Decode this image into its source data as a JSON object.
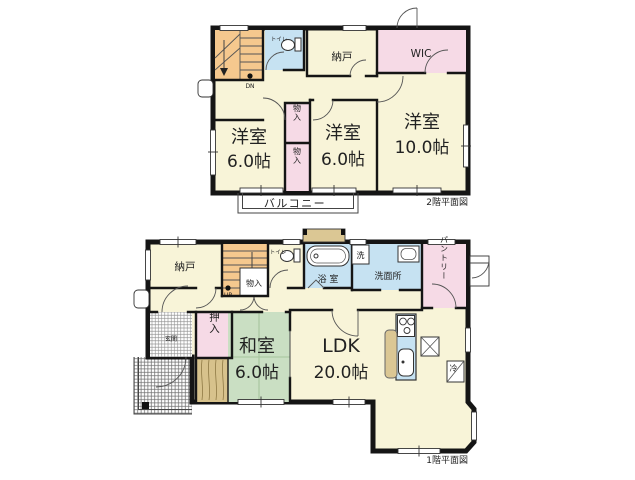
{
  "document": {
    "type": "floor-plan",
    "background": "#ffffff"
  },
  "colors": {
    "wall": "#151515",
    "cream": "#F8F4D8",
    "orange": "#F5C88E",
    "pink": "#F6DAE6",
    "blue": "#C6E2F2",
    "green": "#CADFC3",
    "wood": "#D7C28C",
    "tan": "#DBC794",
    "white": "#FFFFFF"
  },
  "floor2": {
    "title": "2階平面図",
    "stairs": {
      "label": "DN"
    },
    "toilet": {
      "label": "トイレ"
    },
    "storage": {
      "label": "納戸"
    },
    "wic": {
      "label": "WIC"
    },
    "bedroom_left": {
      "name": "洋室",
      "size": "6.0帖"
    },
    "closet_upper": {
      "label": "物入"
    },
    "closet_lower": {
      "label": "物入"
    },
    "bedroom_mid": {
      "name": "洋室",
      "size": "6.0帖"
    },
    "bedroom_right": {
      "name": "洋室",
      "size": "10.0帖"
    },
    "balcony": {
      "label": "バルコニー"
    }
  },
  "floor1": {
    "title": "1階平面図",
    "storage": {
      "label": "納戸"
    },
    "stairs": {
      "label": "UP"
    },
    "closet": {
      "label": "物入"
    },
    "toilet": {
      "label": "トイレ"
    },
    "bath": {
      "label": "浴 室"
    },
    "washer": {
      "label": "洗"
    },
    "washroom": {
      "label": "洗面所"
    },
    "pantry": {
      "label": "パントリー"
    },
    "oshiire": {
      "label": "押入"
    },
    "japanese_room": {
      "name": "和室",
      "size": "6.0帖"
    },
    "ldk": {
      "name": "LDK",
      "size": "20.0帖"
    },
    "entrance": {
      "label": "玄関"
    },
    "fridge": {
      "label": "冷"
    }
  }
}
